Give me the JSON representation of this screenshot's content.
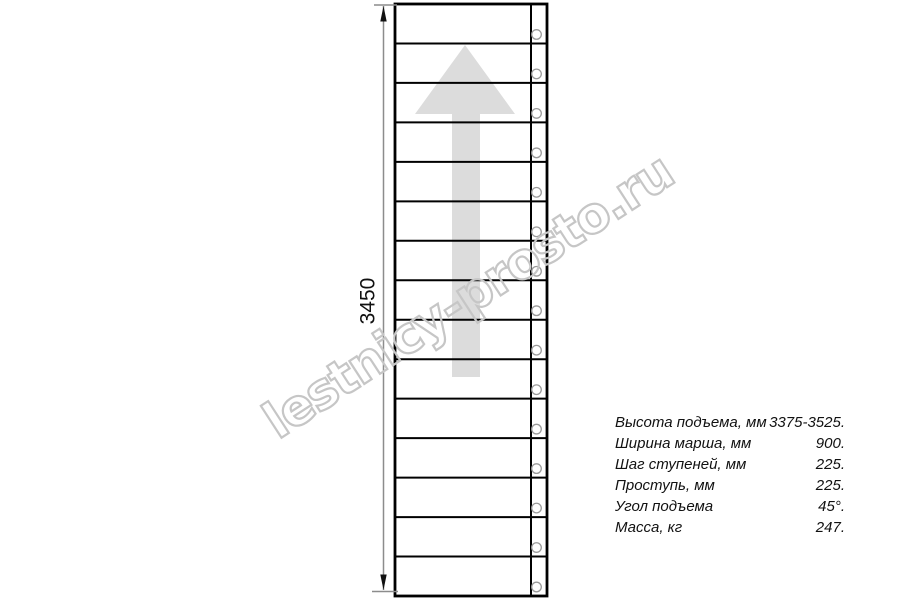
{
  "drawing": {
    "dimension_label": "3450",
    "watermark": "lestnicy-prosto.ru",
    "tread_count": 15,
    "colors": {
      "line": "#000000",
      "arrow_fill": "#dcdcdc",
      "dimension_line": "#8c8c8c",
      "dimension_arrow": "#111111",
      "circle_stroke": "#9a9a9a",
      "watermark_stroke": "#c6c6c6",
      "text": "#111111"
    }
  },
  "specs": {
    "rows": [
      {
        "label": "Высота подъема, мм",
        "value": "3375-3525."
      },
      {
        "label": "Ширина марша, мм",
        "value": "900."
      },
      {
        "label": "Шаг ступеней, мм",
        "value": "225."
      },
      {
        "label": "Проступь, мм",
        "value": "225."
      },
      {
        "label": "Угол подъема",
        "value": "45°."
      },
      {
        "label": "Масса, кг",
        "value": "247."
      }
    ]
  }
}
